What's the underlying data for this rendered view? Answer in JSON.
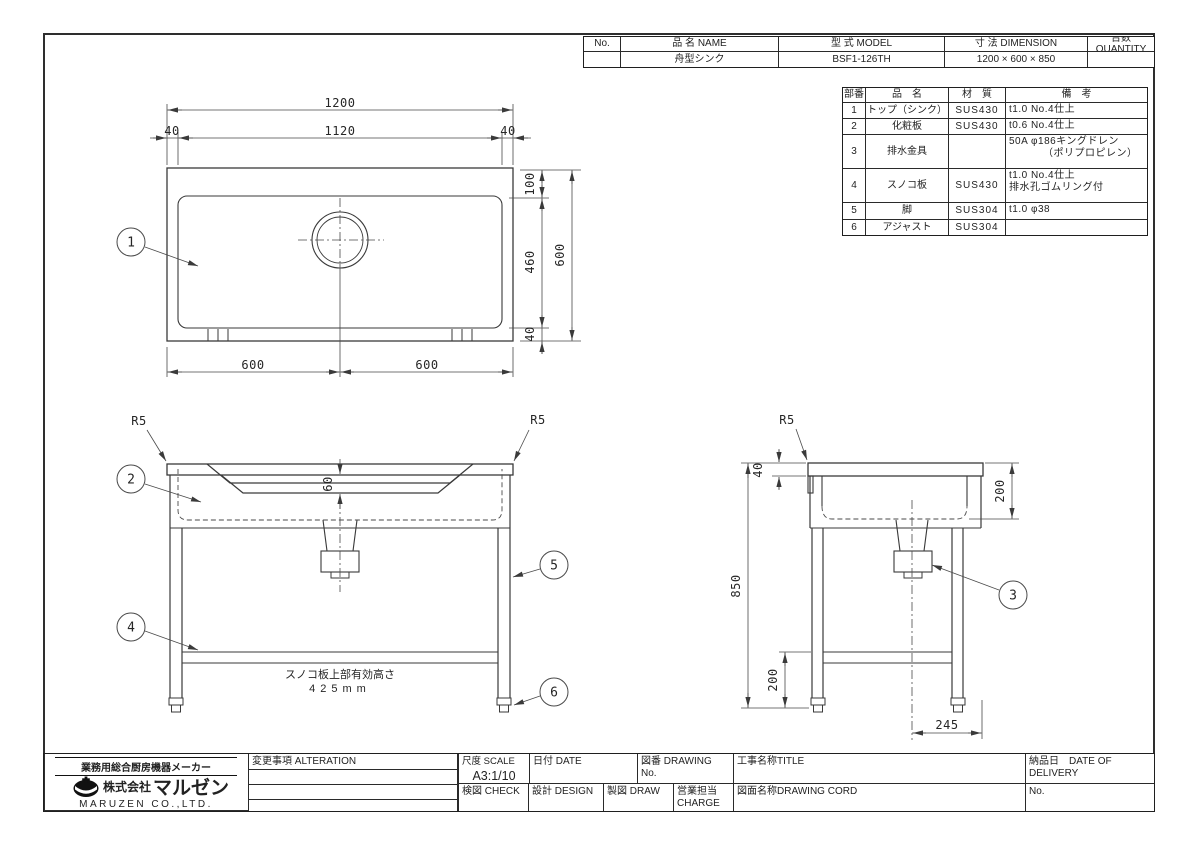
{
  "colors": {
    "ink": "#2a2a2a",
    "line": "#454545",
    "paper": "#ffffff"
  },
  "header_table": {
    "col_no": "No.",
    "col_name": "品 名 NAME",
    "col_model": "型 式 MODEL",
    "col_dimension": "寸 法 DIMENSION",
    "col_quantity": "台数 QUANTITY",
    "row": {
      "no": "",
      "name": "舟型シンク",
      "model": "BSF1-126TH",
      "dimension": "1200 × 600 × 850",
      "quantity": ""
    }
  },
  "parts_table": {
    "headers": {
      "no": "部番",
      "name": "品　名",
      "material": "材　質",
      "remarks": "備　考"
    },
    "rows": [
      {
        "no": "1",
        "name": "トップ（シンク）",
        "material": "SUS430",
        "remarks1": "t1.0 No.4仕上",
        "remarks2": ""
      },
      {
        "no": "2",
        "name": "化粧板",
        "material": "SUS430",
        "remarks1": "t0.6 No.4仕上",
        "remarks2": ""
      },
      {
        "no": "3",
        "name": "排水金具",
        "material": "",
        "remarks1": "50A φ186キングドレン",
        "remarks2": "（ポリプロピレン）"
      },
      {
        "no": "4",
        "name": "スノコ板",
        "material": "SUS430",
        "remarks1": "t1.0 No.4仕上",
        "remarks2": "排水孔ゴムリング付"
      },
      {
        "no": "5",
        "name": "脚",
        "material": "SUS304",
        "remarks1": "t1.0 φ38",
        "remarks2": ""
      },
      {
        "no": "6",
        "name": "アジャスト",
        "material": "SUS304",
        "remarks1": "",
        "remarks2": ""
      }
    ]
  },
  "title_block": {
    "alteration_label": "変更事項 ALTERATION",
    "scale_label": "尺度 SCALE",
    "scale_value": "A3:1/10",
    "date_label": "日付 DATE",
    "drawing_no_label": "図番 DRAWING No.",
    "title_label": "工事名称TITLE",
    "delivery_label": "納品日　DATE OF DELIVERY",
    "check_label": "検図 CHECK",
    "design_label": "設計 DESIGN",
    "draw_label": "製図 DRAW",
    "charge_label": "営業担当CHARGE",
    "drawing_cord_label": "図面名称DRAWING CORD",
    "no_label": "No."
  },
  "company": {
    "tagline": "業務用総合厨房機器メーカー",
    "name_prefix": "株式会社",
    "name": "マルゼン",
    "name_en": "MARUZEN CO.,LTD."
  },
  "drawing": {
    "top_view": {
      "dim_1200": "1200",
      "dim_1120": "1120",
      "dim_40_left": "40",
      "dim_40_right": "40",
      "dim_100": "100",
      "dim_460": "460",
      "dim_40_bottom": "40",
      "dim_600_side": "600",
      "dim_600_bl": "600",
      "dim_600_br": "600",
      "balloon_1": "1"
    },
    "front_view": {
      "r5_left": "R5",
      "r5_right": "R5",
      "dim_60": "60",
      "balloon_2": "2",
      "balloon_4": "4",
      "balloon_5": "5",
      "balloon_6": "6",
      "note_line1": "スノコ板上部有効高さ",
      "note_line2": "425mm"
    },
    "side_view": {
      "r5": "R5",
      "dim_40": "40",
      "dim_850": "850",
      "dim_200_top": "200",
      "dim_200_bottom": "200",
      "dim_245": "245",
      "balloon_3": "3"
    }
  }
}
